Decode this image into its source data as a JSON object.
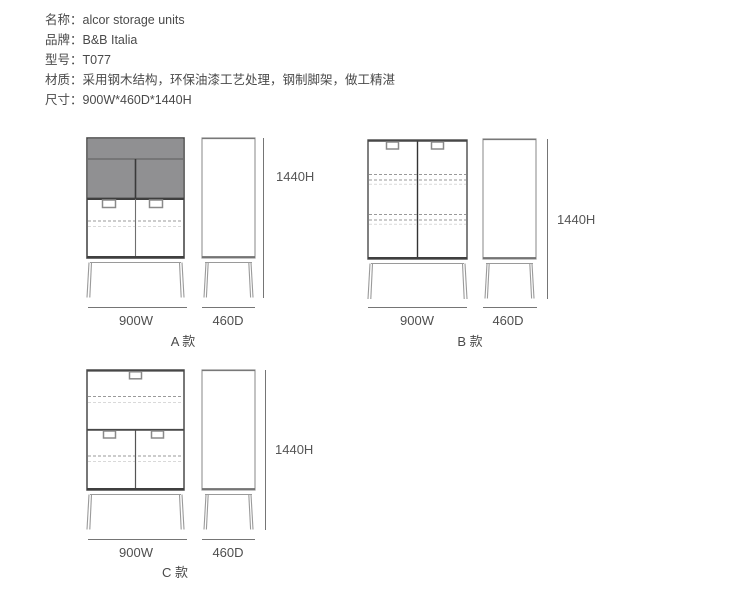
{
  "specs": {
    "lines": [
      "名称：alcor storage units",
      "品牌：B&B Italia",
      "型号：T077",
      "材质：采用钢木结构，环保油漆工艺处理，钢制脚架，做工精湛",
      "尺寸：900W*460D*1440H"
    ]
  },
  "figures": [
    {
      "id": "A",
      "variant": "A 款",
      "width": "900W",
      "depth": "460D",
      "height": "1440H"
    },
    {
      "id": "B",
      "variant": "B 款",
      "width": "900W",
      "depth": "460D",
      "height": "1440H"
    },
    {
      "id": "C",
      "variant": "C 款",
      "width": "900W",
      "depth": "460D",
      "height": "1440H"
    }
  ],
  "colors": {
    "door_fill": "#909092",
    "outline_dark": "#4a4a4a",
    "outline_light": "#9b9b9b",
    "dash_dark": "#9a9a9a",
    "dash_light": "#d9d9d9",
    "dim_line": "#757575",
    "text": "#4a4a4a"
  }
}
